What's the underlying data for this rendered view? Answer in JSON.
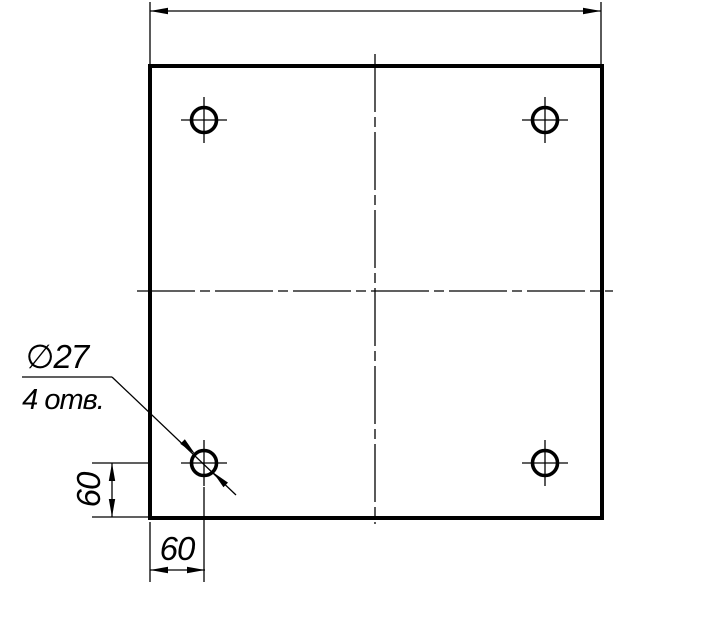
{
  "drawing": {
    "annotation": {
      "diameter_label": "∅27",
      "holes_label": "4 отв."
    },
    "dimensions": {
      "left_offset": "60",
      "bottom_offset": "60"
    },
    "colors": {
      "line": "#000000",
      "background": "#ffffff"
    }
  }
}
